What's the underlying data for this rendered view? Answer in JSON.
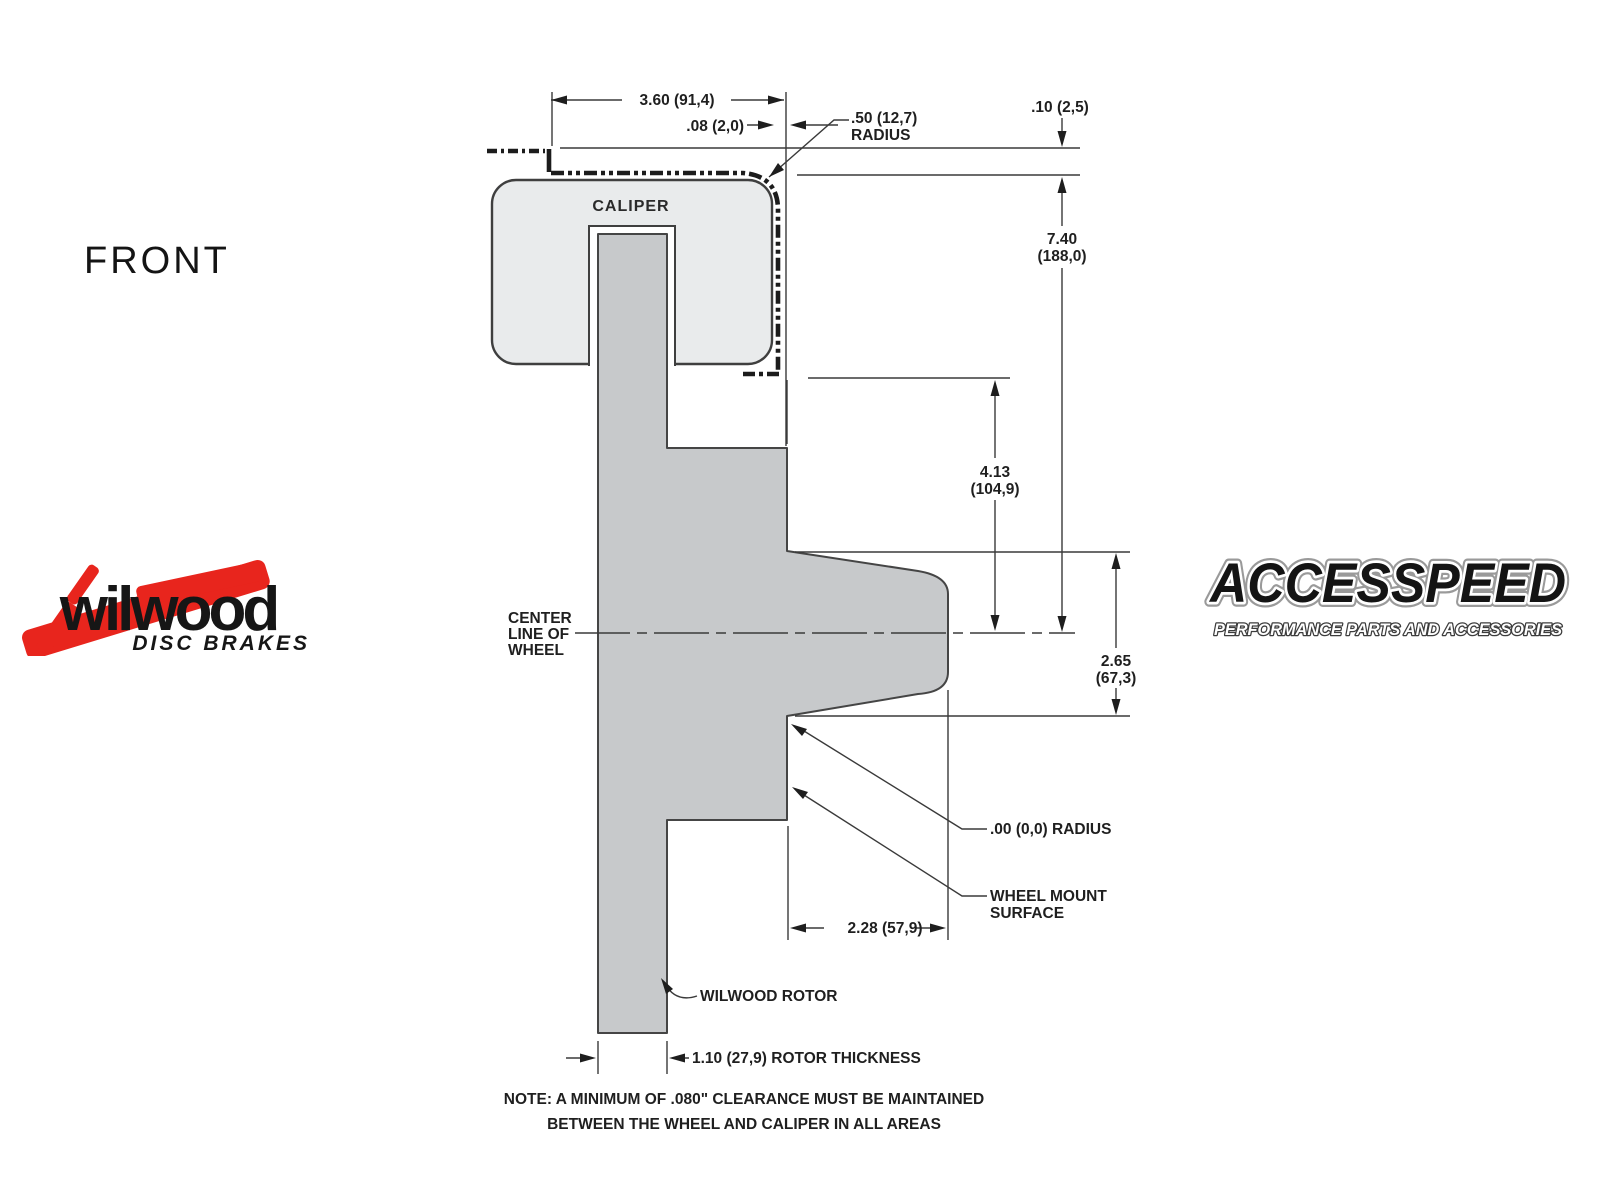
{
  "front_label": "FRONT",
  "caliper_label": "CALIPER",
  "centerline": {
    "l1": "CENTER",
    "l2": "LINE OF",
    "l3": "WHEEL"
  },
  "dims": {
    "width_top": "3.60 (91,4)",
    "clearance_side": ".08 (2,0)",
    "radius_caliper_l1": ".50 (12,7)",
    "radius_caliper_l2": "RADIUS",
    "clearance_top": ".10 (2,5)",
    "caliper_height_l1": "7.40",
    "caliper_height_l2": "(188,0)",
    "wheel_inner_l1": "4.13",
    "wheel_inner_l2": "(104,9)",
    "hub_height_l1": "2.65",
    "hub_height_l2": "(67,3)",
    "radius_zero": ".00 (0,0) RADIUS",
    "wheel_mount_l1": "WHEEL MOUNT",
    "wheel_mount_l2": "SURFACE",
    "mount_depth": "2.28 (57,9)",
    "rotor_callout": "WILWOOD ROTOR",
    "rotor_thickness": "1.10 (27,9) ROTOR THICKNESS"
  },
  "note": {
    "l1": "NOTE: A MINIMUM OF .080\" CLEARANCE MUST BE MAINTAINED",
    "l2": "BETWEEN THE WHEEL AND CALIPER IN ALL AREAS"
  },
  "logos": {
    "wilwood_name": "wilwood",
    "wilwood_sub": "DISC BRAKES",
    "accesspeed_name": "ACCESSPEED",
    "accesspeed_sub": "PERFORMANCE PARTS AND ACCESSORIES"
  },
  "colors": {
    "caliper_fill": "#e9ebec",
    "rotor_fill": "#c7c9cb",
    "line": "#3a3a3a",
    "logo_red": "#e8251d"
  }
}
